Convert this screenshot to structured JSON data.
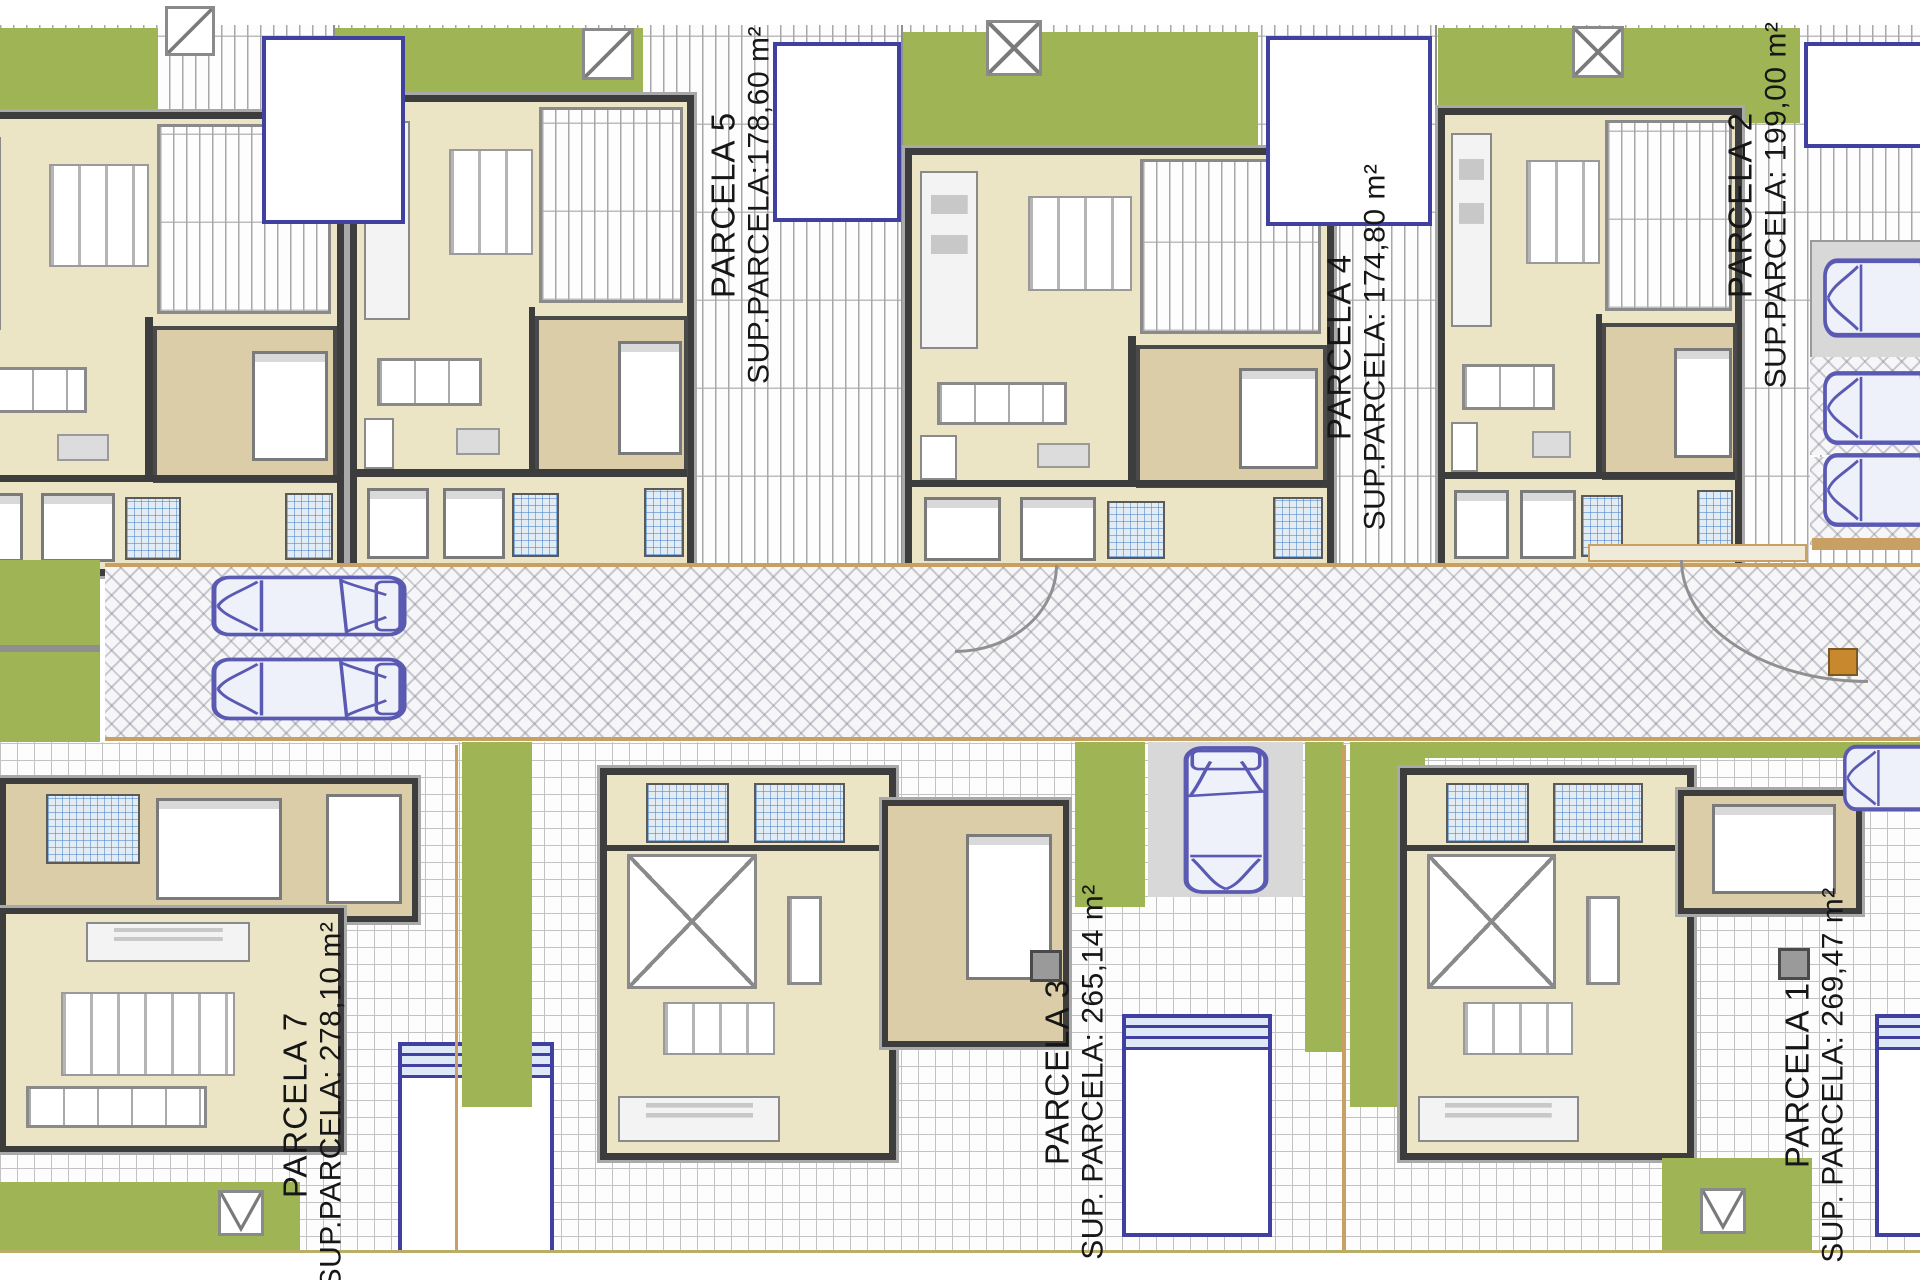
{
  "plan": {
    "parcels": [
      {
        "name": "PARCELA 5",
        "area": "SUP.PARCELA:178,60 m²"
      },
      {
        "name": "PARCELA 4",
        "area": "SUP.PARCELA: 174,80 m²"
      },
      {
        "name": "PARCELA 2",
        "area": "SUP.PARCELA: 199,00 m²"
      },
      {
        "name": "PARCELA 7",
        "area": "SUP.PARCELA: 278,10 m²"
      },
      {
        "name": "PARCELA 3",
        "area": "SUP. PARCELA: 265,14 m²"
      },
      {
        "name": "PARCELA 1",
        "area": "SUP. PARCELA: 269,47 m²"
      }
    ],
    "colors": {
      "lawn": "#9fb455",
      "floor": "#ebe5c5",
      "room": "#dbcda8",
      "wall": "#3d3d3d",
      "pool_border": "#4040a0",
      "car_blue": "#5a5ab2",
      "accent_orange": "#c8882d",
      "boundary_tan": "#c9a063",
      "hatch_gray": "#a8a8a8"
    }
  }
}
